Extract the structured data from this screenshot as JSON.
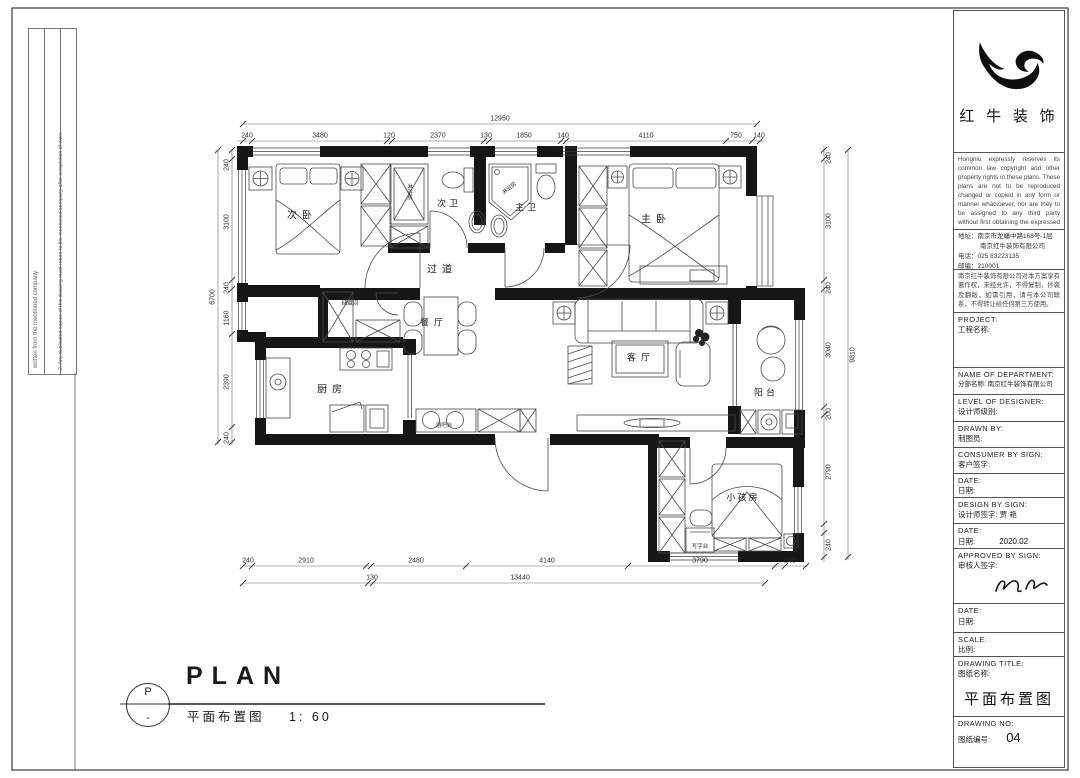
{
  "sheet_notes": {
    "note1": "written from the mentioned company.",
    "note2": "2. Any duplicated copies of this drawing must return to the mentioned company after completion of work."
  },
  "brand": {
    "name": "红 牛 装 饰",
    "logo": "bull-swoosh-logo"
  },
  "title_block": {
    "copyright_en": "Hongniu expressly reserves its common law copyright and other property rights in these plans. These plans are not to be reproduced changed or copied in any form or manner whatsoever, nor are they to be assigned to any third party without first obtaining the expressed written permission and",
    "address_line1": "地址：南京市龙蟠中路168号-1层",
    "address_line2": "南京红牛装饰有限公司",
    "phone": "电话：025 83223135",
    "postcode": "邮编：210001",
    "copyright_cn": "南京红牛装饰有限公司对本方案享有著作权，未经允许，不得复制、抄袭及翻版，如需引用，请与本公司联系，不得转让给任何第三方使用。",
    "fields": [
      {
        "en": "PROJECT:",
        "cn": "工程名称:",
        "value": ""
      },
      {
        "en": "NAME OF DEPARTMENT:",
        "cn": "分部名称: 南京红牛装饰有限公司",
        "value": ""
      },
      {
        "en": "LEVEL OF DESIGNER:",
        "cn": "设计师级别:",
        "value": ""
      },
      {
        "en": "DRAWN BY:",
        "cn": "制图员:",
        "value": ""
      },
      {
        "en": "CONSUMER BY SIGN:",
        "cn": "客户签字:",
        "value": ""
      },
      {
        "en": "DATE:",
        "cn": "日期:",
        "value": ""
      },
      {
        "en": "DESIGN BY SIGN:",
        "cn": "设计师签字: 贾 艳",
        "value": ""
      },
      {
        "en": "DATE:",
        "cn": "日期:",
        "value": "2020.02"
      },
      {
        "en": "APPROVED BY SIGN:",
        "cn": "审核人签字:",
        "value": ""
      },
      {
        "en": "DATE:",
        "cn": "日期:",
        "value": ""
      },
      {
        "en": "SCALE:",
        "cn": "比例:",
        "value": ""
      },
      {
        "en": "DRAWING TITLE:",
        "cn": "图纸名称:",
        "value": "平面布置图"
      },
      {
        "en": "DRAWING NO:",
        "cn": "图纸编号:",
        "value": "04"
      }
    ]
  },
  "plan": {
    "rooms": [
      "次卧",
      "次卫",
      "主卫",
      "主卧",
      "过道",
      "餐厅",
      "客厅",
      "厨房",
      "阳台",
      "小孩房"
    ],
    "fixtures": {
      "shower1": "淋浴房",
      "shower2": "淋浴房",
      "storage": "储藏间",
      "bar": "酒吧台",
      "desk": "写字台"
    },
    "dims": {
      "top_total": "12950",
      "top": [
        "240",
        "3480",
        "120",
        "2370",
        "130",
        "1850",
        "140",
        "4110",
        "750",
        "140"
      ],
      "left_total": "6700",
      "left": [
        "240",
        "3100",
        "240",
        "1160",
        "2390",
        "240"
      ],
      "right_total": "9810",
      "right": [
        "240",
        "3100",
        "240",
        "3040",
        "200",
        "2790",
        "240"
      ],
      "bottom": [
        "240",
        "2910",
        "2480",
        "4140",
        "3790",
        "240"
      ],
      "bottom_sub": [
        "130",
        "13440"
      ]
    }
  },
  "footer": {
    "symbol_top": "P",
    "symbol_bottom": "-",
    "title_en": "PLAN",
    "title_cn": "平面布置图",
    "scale": "1: 60"
  }
}
